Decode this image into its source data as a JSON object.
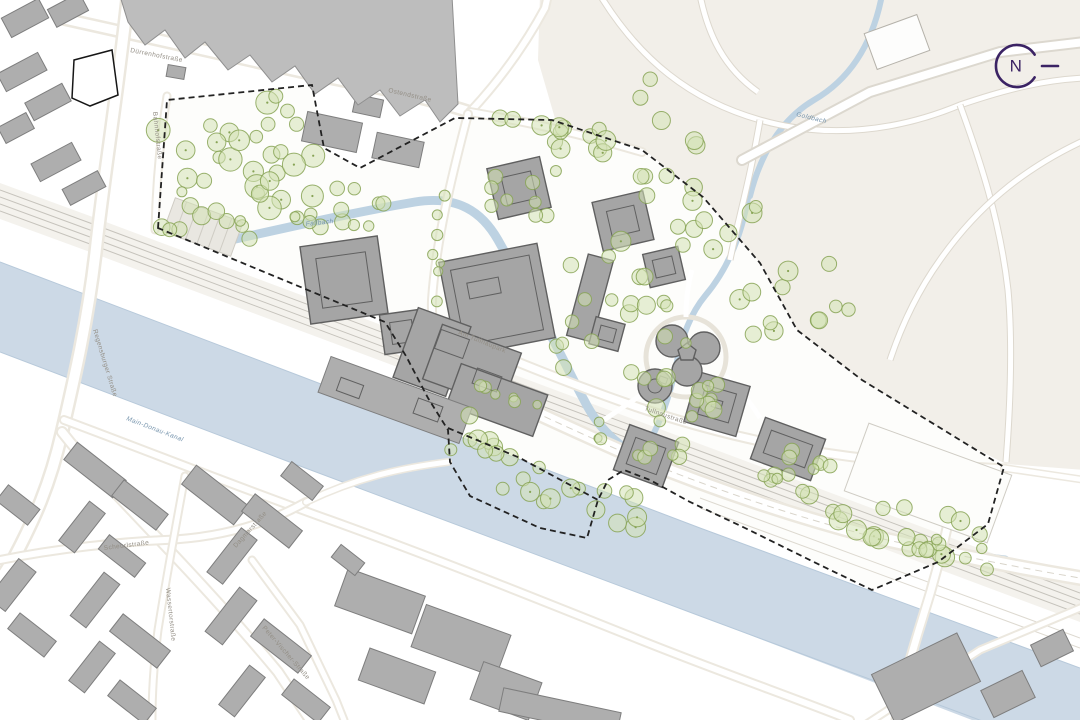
{
  "map": {
    "compass": {
      "letter": "N"
    },
    "street_labels": {
      "duerrenhofstrasse": {
        "text": "Dürrenhofstraße"
      },
      "ostendstrasse": {
        "text": "Ostendstraße"
      },
      "bahnhofstrasse": {
        "text": "Bahnhofstraße"
      },
      "regensburger": {
        "text": "Regensburger Straße"
      },
      "am_tullnaupark": {
        "text": "Am Tullnaupark"
      },
      "tullnaustrasse": {
        "text": "Tullnaustraße"
      },
      "scheurlstrasse": {
        "text": "Scheurlstraße"
      },
      "dagmarstrasse": {
        "text": "Dagmarstraße"
      },
      "wassertorstrasse": {
        "text": "Wassertorstraße"
      },
      "peter_vischer": {
        "text": "Peter-Vischer-Straße"
      }
    },
    "water_labels": {
      "fallbach": {
        "text": "Fallbach"
      },
      "goldbach": {
        "text": "Goldbach"
      },
      "canal": {
        "text": "Main-Donau-Kanal"
      }
    },
    "colors": {
      "background": "#ffffff",
      "park": "#f2efe9",
      "water": "#ccd9e6",
      "water_edge": "#b7c9da",
      "stream": "#bdd2e2",
      "tree_fill": "#d3e1b4",
      "tree_stroke": "#87a355",
      "road_fill": "#ffffff",
      "road_casing": "#dcd8cf",
      "road_beige": "#ece8df",
      "rail_band": "#f4f2ed",
      "rail_line": "#c6c3bc",
      "building": "#a5a5a5",
      "building_stroke": "#606060",
      "city_building": "#aeaeae",
      "city_building_stroke": "#7e7e7e",
      "big_building": "#bdbdbd",
      "field": "#fdfdfb",
      "boundary": "#222222",
      "label": "#938e85",
      "water_label": "#7795ad",
      "compass": "#3b2364"
    }
  }
}
